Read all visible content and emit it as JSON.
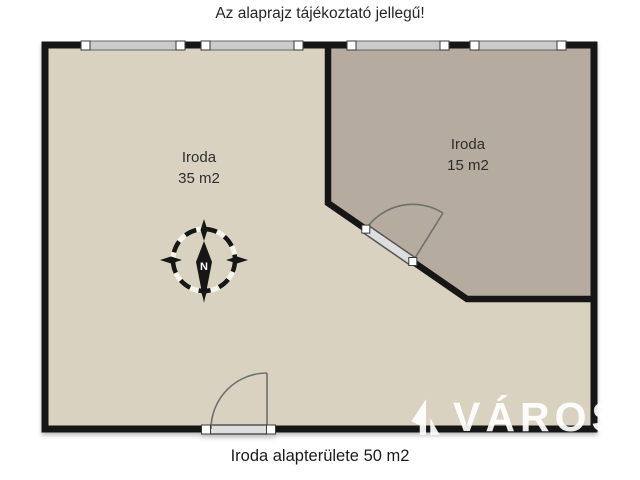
{
  "disclaimer": "Az alaprajz tájékoztató jellegű!",
  "caption": "Iroda alapterülete 50 m2",
  "plan": {
    "rooms": [
      {
        "label": "Iroda",
        "area": "35 m2",
        "fill": "#d9d2c1"
      },
      {
        "label": "Iroda",
        "area": "15 m2",
        "fill": "#b5ab9e"
      }
    ],
    "compass": {
      "north_label": "N"
    },
    "features": [
      "window-band-top-wall",
      "door-on-diagonal-wall",
      "door-on-bottom-wall"
    ],
    "colors": {
      "wall": "#161616",
      "window_band": "#cbcbcb",
      "door_band": "#dedede",
      "swing_line": "#6f6f6f",
      "background": "#ffffff"
    }
  },
  "watermark": {
    "text": "VÁROS",
    "logo": "varos-logo"
  }
}
